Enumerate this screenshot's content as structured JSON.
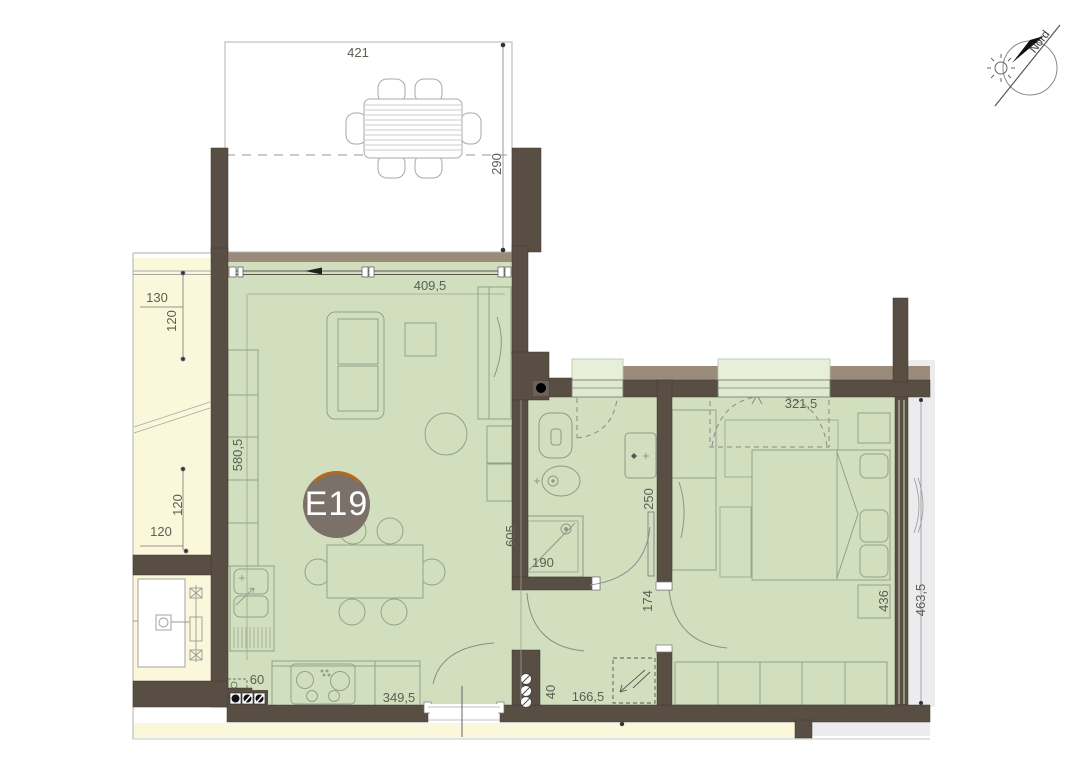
{
  "unit_badge": {
    "label": "E19"
  },
  "compass": {
    "label": "Nord"
  },
  "dims": {
    "terrace_width": "421",
    "terrace_depth": "290",
    "living_width": "409,5",
    "living_depth": "580,5",
    "neighbor_width_top": "130",
    "neighbor_depth_top": "120",
    "neighbor_depth_bottom": "120",
    "neighbor_width_bottom": "120",
    "living_height": "605",
    "shower_width": "190",
    "bath_width": "250",
    "hall_door_width": "174",
    "bedroom_width": "321,5",
    "bedroom_depth": "436",
    "facade_height": "463,5",
    "kitchen_offset": "60",
    "kitchen_run": "349,5",
    "entry_offset": "40",
    "entry_run": "166,5"
  },
  "colors": {
    "room_green": "#d2dfbe",
    "window_green": "#dfe9d2",
    "reveal_green": "#e7eed9",
    "corridor_yellow": "#fbf7da",
    "wall_brown": "#584e43",
    "lintel_tan": "#9a8b7b",
    "exterior_gray": "#ececee",
    "badge_fill": "#7b7168",
    "badge_ring": "#b4691c",
    "furniture_line": "#93a08c",
    "dim_text": "#5a5f54"
  }
}
